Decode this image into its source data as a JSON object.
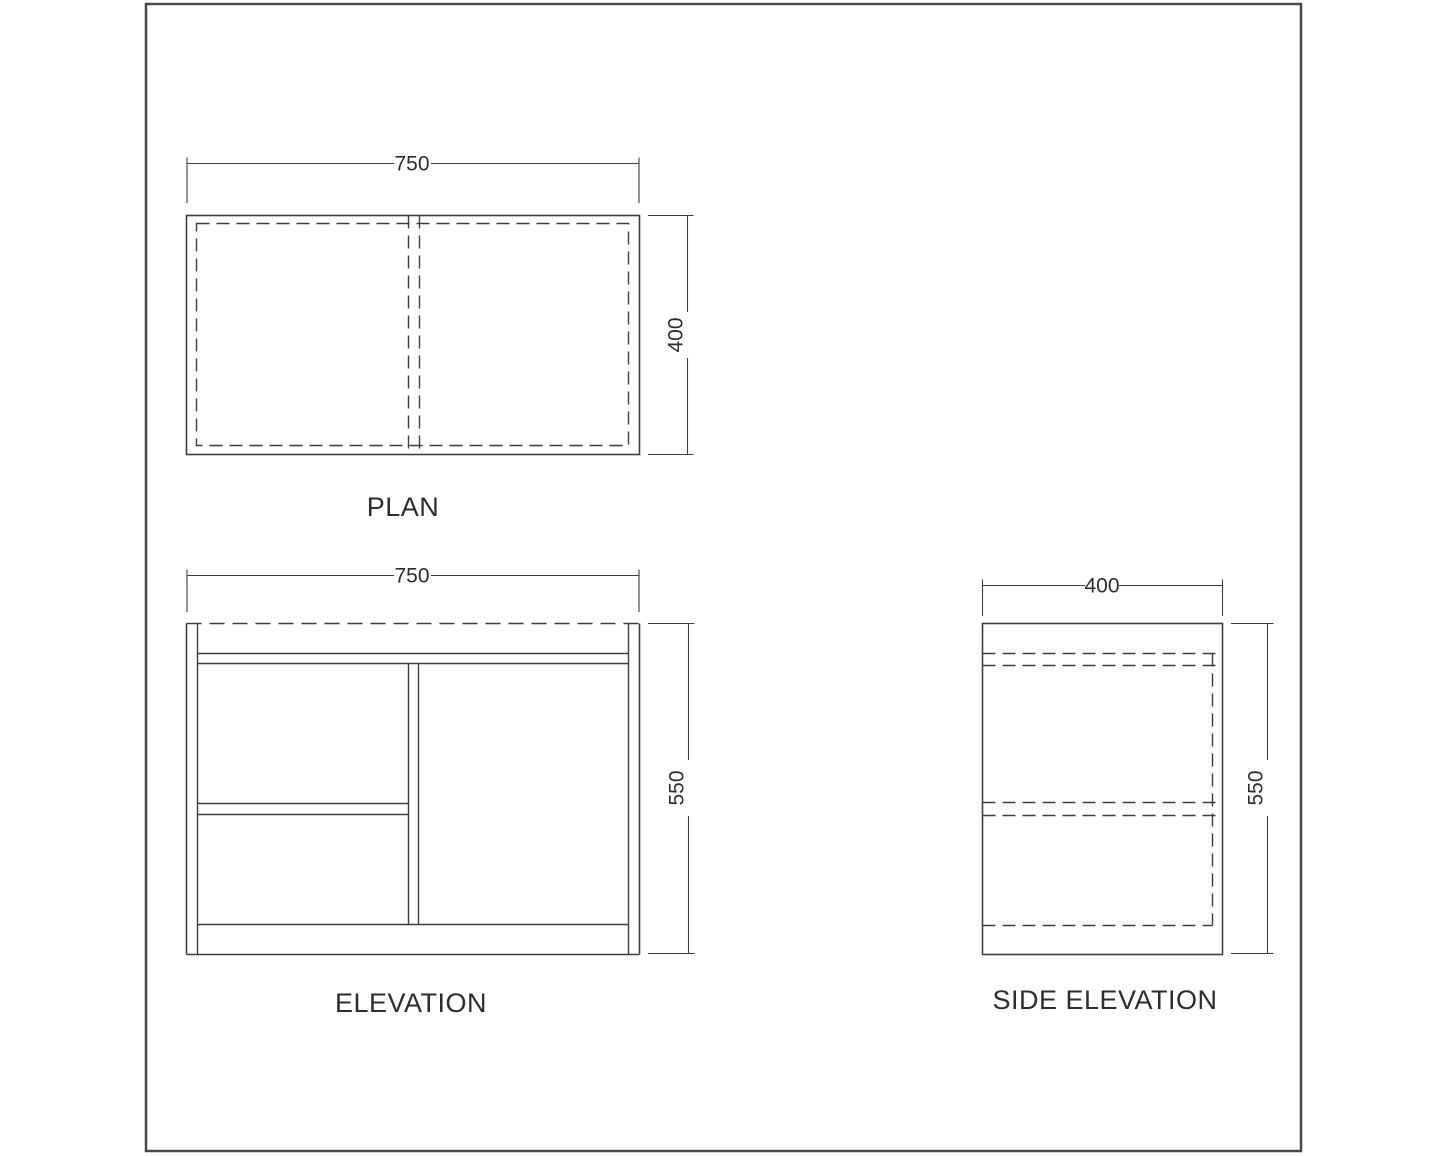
{
  "page": {
    "background": "#ffffff",
    "border_color": "#4a4a4a",
    "line_color": "#3e3e3e",
    "text_color": "#2d2d2d"
  },
  "plan": {
    "title": "PLAN",
    "width_label": "750",
    "depth_label": "400"
  },
  "elevation": {
    "title": "ELEVATION",
    "width_label": "750",
    "height_label": "550"
  },
  "side_elevation": {
    "title": "SIDE ELEVATION",
    "width_label": "400",
    "height_label": "550"
  }
}
